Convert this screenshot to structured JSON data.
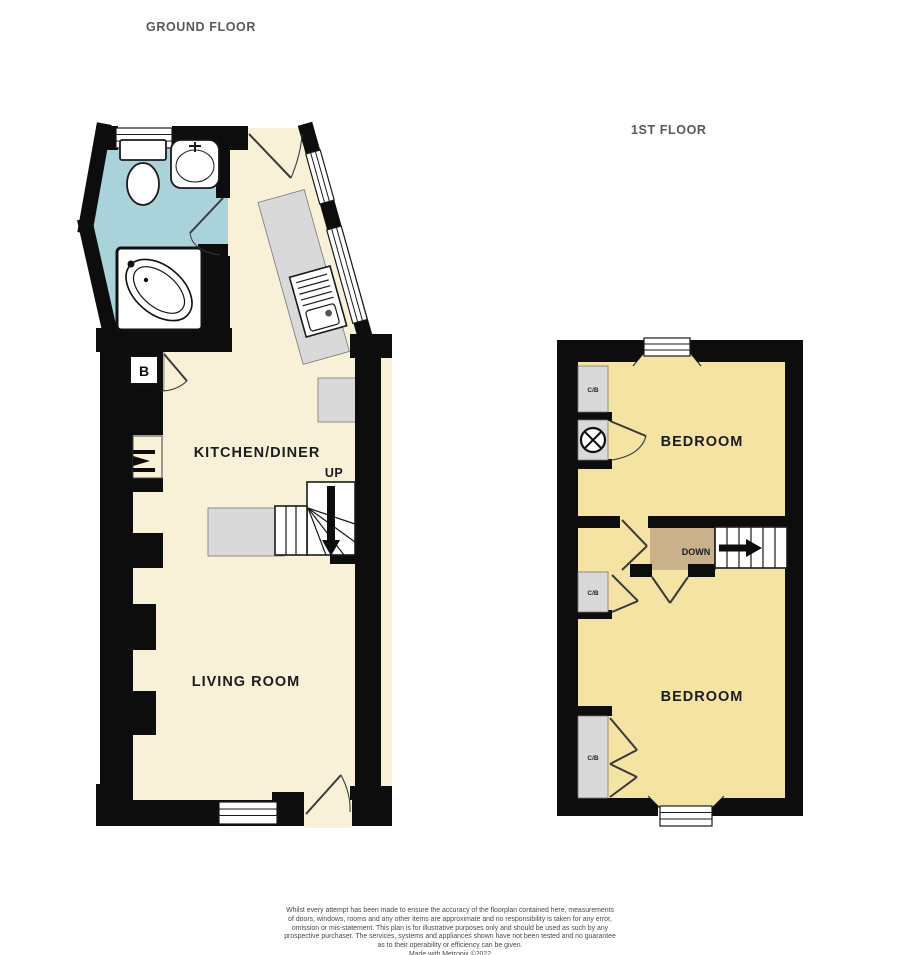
{
  "colors": {
    "wall": "#0d0d0d",
    "bathroom-floor": "#a9d2db",
    "ground-floor-cream": "#f8f1d8",
    "bedroom-yellow": "#f5e3a3",
    "landing-tan": "#c8b18b",
    "fixture-gray": "#d9d9d9",
    "title-gray": "#58595b",
    "label-dark": "#1c1c1c",
    "disclaimer-gray": "#4a4a4a"
  },
  "titles": {
    "ground_floor": "GROUND FLOOR",
    "first_floor": "1ST FLOOR"
  },
  "ground_floor": {
    "rooms": {
      "kitchen_diner": "KITCHEN/DINER",
      "living_room": "LIVING ROOM"
    },
    "stairs_label": "UP",
    "boiler_label": "B"
  },
  "first_floor": {
    "rooms": {
      "bedroom_front": "BEDROOM",
      "bedroom_back": "BEDROOM"
    },
    "stairs_label": "DOWN",
    "cupboards": {
      "top": "C/B",
      "middle": "C/B",
      "bottom": "C/B"
    }
  },
  "disclaimer": {
    "lines": [
      "Whilst every attempt has been made to ensure the accuracy of the floorplan contained here, measurements",
      "of doors, windows, rooms and any other items are approximate and no responsibility is taken for any error,",
      "omission or mis-statement. This plan is for illustrative purposes only and should be used as such by any",
      "prospective purchaser. The services, systems and appliances shown have not been tested and no guarantee",
      "as to their operability or efficiency can be given."
    ],
    "credit": "Made with Metropix ©2022"
  }
}
